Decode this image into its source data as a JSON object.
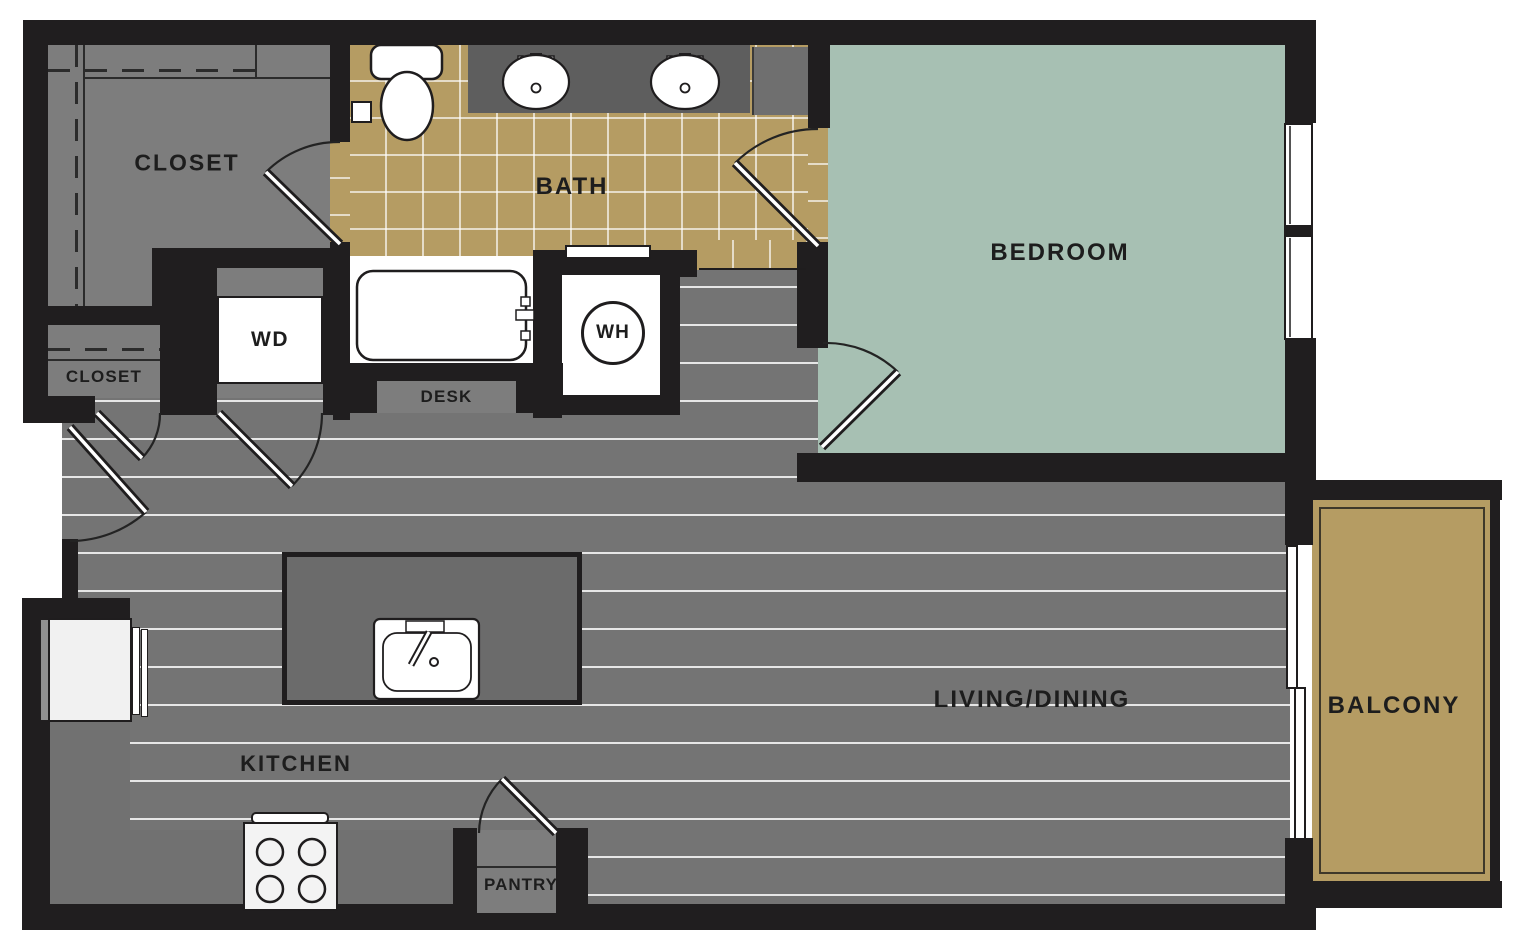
{
  "plan": {
    "type": "apartment-floor-plan",
    "rooms": {
      "closet_main": {
        "label": "CLOSET"
      },
      "closet_hall": {
        "label": "CLOSET"
      },
      "bath": {
        "label": "BATH"
      },
      "bedroom": {
        "label": "BEDROOM"
      },
      "washer_dryer": {
        "label": "WD"
      },
      "water_heater": {
        "label": "WH"
      },
      "desk": {
        "label": "DESK"
      },
      "living_dining": {
        "label": "LIVING/DINING"
      },
      "kitchen": {
        "label": "KITCHEN"
      },
      "pantry": {
        "label": "PANTRY"
      },
      "balcony": {
        "label": "BALCONY"
      }
    },
    "colors": {
      "wall": "#201e1f",
      "wood_floor": "#747474",
      "wood_stripe": "#e8e8e8",
      "bath_tile": "#b59c63",
      "bedroom_fill": "#a7c0b3",
      "balcony_fill": "#b59c63",
      "closet_fill": "#7d7d7d",
      "counter_fill": "#717171",
      "island_fill": "#6b6b6b",
      "vanity_fill": "#5e5e5e",
      "fixture_white": "#ffffff"
    }
  }
}
